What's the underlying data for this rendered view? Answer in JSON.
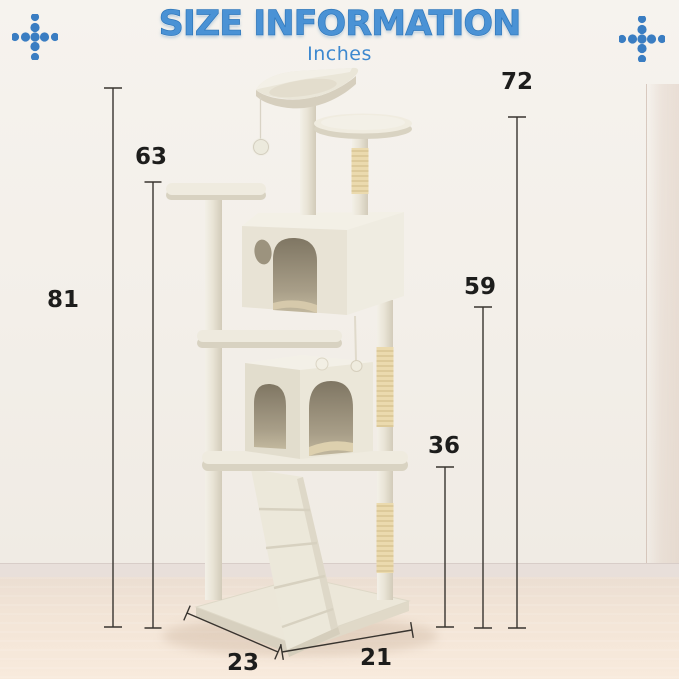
{
  "header": {
    "title": "SIZE INFORMATION",
    "unit_label": "Inches"
  },
  "decor": {
    "left_icon": "dots-cross-icon",
    "right_icon": "dots-cross-icon"
  },
  "measurements": {
    "m81": {
      "value": "81"
    },
    "m63": {
      "value": "63"
    },
    "m72": {
      "value": "72"
    },
    "m59": {
      "value": "59"
    },
    "m36": {
      "value": "36"
    },
    "m23": {
      "value": "23"
    },
    "m21": {
      "value": "21"
    }
  },
  "colors": {
    "accent_blue": "#4a92d5",
    "dot_blue": "#3a7dc2",
    "measurement_text": "#1d1d1c",
    "plush": "#eae5d8",
    "sisal": "#ecdcb2"
  }
}
